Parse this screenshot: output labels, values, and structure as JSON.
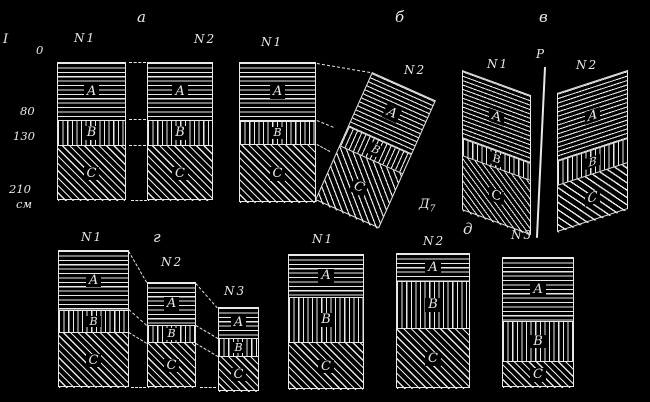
{
  "canvas": {
    "w": 650,
    "h": 402,
    "bg": "#000000",
    "ink": "#e8e8e8"
  },
  "section_label": {
    "text": "I"
  },
  "depth_scale": {
    "unit": "см",
    "unit_pos": {
      "x": 16,
      "y": 199
    },
    "labels": [
      {
        "text": "0",
        "x": 36,
        "y": 45
      },
      {
        "text": "80",
        "x": 20,
        "y": 106
      },
      {
        "text": "130",
        "x": 13,
        "y": 131
      },
      {
        "text": "210",
        "x": 9,
        "y": 184
      }
    ]
  },
  "horizon_letters": [
    "А",
    "В",
    "С"
  ],
  "hatch_styles": [
    "horizontal-lines",
    "vertical-lines",
    "diagonal-lines"
  ],
  "panels": [
    {
      "id": "a",
      "label": "а",
      "label_pos": {
        "x": 137,
        "y": 10
      },
      "boreholes": [
        {
          "label": "N1",
          "label_pos": {
            "x": 74,
            "y": 32
          },
          "x": 57,
          "y": 62,
          "w": 69,
          "h": 138,
          "layers": [
            57,
            26,
            55
          ],
          "transform": ""
        },
        {
          "label": "N2",
          "label_pos": {
            "x": 194,
            "y": 33
          },
          "x": 147,
          "y": 62,
          "w": 66,
          "h": 138,
          "layers": [
            57,
            26,
            55
          ],
          "transform": ""
        }
      ],
      "dashes": [
        [
          129,
          62,
          146,
          62
        ],
        [
          129,
          119,
          146,
          119
        ],
        [
          129,
          145,
          146,
          145
        ],
        [
          131,
          200,
          147,
          200
        ]
      ]
    },
    {
      "id": "b",
      "label": "б",
      "label_pos": {
        "x": 395,
        "y": 10
      },
      "boreholes": [
        {
          "label": "N1",
          "label_pos": {
            "x": 261,
            "y": 36
          },
          "x": 239,
          "y": 62,
          "w": 77,
          "h": 140,
          "layers": [
            58,
            24,
            58
          ],
          "transform": ""
        },
        {
          "label": "N2",
          "label_pos": {
            "x": 404,
            "y": 64
          },
          "x": 372,
          "y": 72,
          "w": 70,
          "h": 140,
          "layers": [
            58,
            22,
            60
          ],
          "transform": "rotate(24deg)"
        }
      ],
      "dashes": [
        [
          317,
          63,
          370,
          72
        ],
        [
          317,
          120,
          334,
          127
        ],
        [
          317,
          144,
          330,
          151
        ]
      ]
    },
    {
      "id": "v",
      "label": "в",
      "label_pos": {
        "x": 539,
        "y": 10
      },
      "fault": {
        "label": "Р",
        "label_pos": {
          "x": 536,
          "y": 48
        },
        "x": 544,
        "y": 67,
        "len": 171,
        "angle": 2.7
      },
      "boreholes": [
        {
          "label": "N1",
          "label_pos": {
            "x": 487,
            "y": 58
          },
          "x": 462,
          "y": 70,
          "w": 69,
          "h": 140,
          "layers": [
            67,
            18,
            55
          ],
          "transform": "skewY(20deg)"
        },
        {
          "label": "N2",
          "label_pos": {
            "x": 576,
            "y": 59
          },
          "x": 557,
          "y": 93,
          "w": 71,
          "h": 139,
          "layers": [
            67,
            25,
            47
          ],
          "transform": "skewY(-18deg)"
        }
      ],
      "dashes": []
    },
    {
      "id": "g",
      "label": "г",
      "label_pos": {
        "x": 153,
        "y": 230
      },
      "boreholes": [
        {
          "label": "N1",
          "label_pos": {
            "x": 81,
            "y": 231
          },
          "x": 58,
          "y": 250,
          "w": 71,
          "h": 137,
          "layers": [
            59,
            23,
            55
          ],
          "transform": ""
        },
        {
          "label": "N2",
          "label_pos": {
            "x": 161,
            "y": 256
          },
          "x": 147,
          "y": 282,
          "w": 49,
          "h": 105,
          "layers": [
            42,
            18,
            45
          ],
          "transform": ""
        },
        {
          "label": "N3",
          "label_pos": {
            "x": 224,
            "y": 285
          },
          "x": 218,
          "y": 307,
          "w": 41,
          "h": 84,
          "layers": [
            30,
            19,
            35
          ],
          "transform": ""
        }
      ],
      "dashes": [
        [
          129,
          251,
          147,
          282
        ],
        [
          129,
          309,
          147,
          325
        ],
        [
          129,
          332,
          147,
          343
        ],
        [
          131,
          387,
          146,
          387
        ],
        [
          196,
          283,
          218,
          308
        ],
        [
          196,
          325,
          218,
          338
        ],
        [
          196,
          343,
          218,
          356
        ],
        [
          200,
          387,
          216,
          387
        ]
      ]
    },
    {
      "id": "d",
      "label": "д",
      "label_pos": {
        "x": 463,
        "y": 222
      },
      "extra_label": {
        "main": "Д",
        "sub": "7"
      },
      "boreholes": [
        {
          "label": "N1",
          "label_pos": {
            "x": 312,
            "y": 233
          },
          "x": 288,
          "y": 254,
          "w": 76,
          "h": 135,
          "layers": [
            42,
            46,
            47
          ],
          "transform": ""
        },
        {
          "label": "N2",
          "label_pos": {
            "x": 423,
            "y": 235
          },
          "x": 396,
          "y": 253,
          "w": 74,
          "h": 135,
          "layers": [
            27,
            48,
            60
          ],
          "transform": ""
        },
        {
          "label": "N3",
          "label_pos": {
            "x": 511,
            "y": 229
          },
          "x": 502,
          "y": 257,
          "w": 72,
          "h": 130,
          "layers": [
            63,
            41,
            26
          ],
          "transform": ""
        }
      ],
      "dashes": []
    }
  ]
}
